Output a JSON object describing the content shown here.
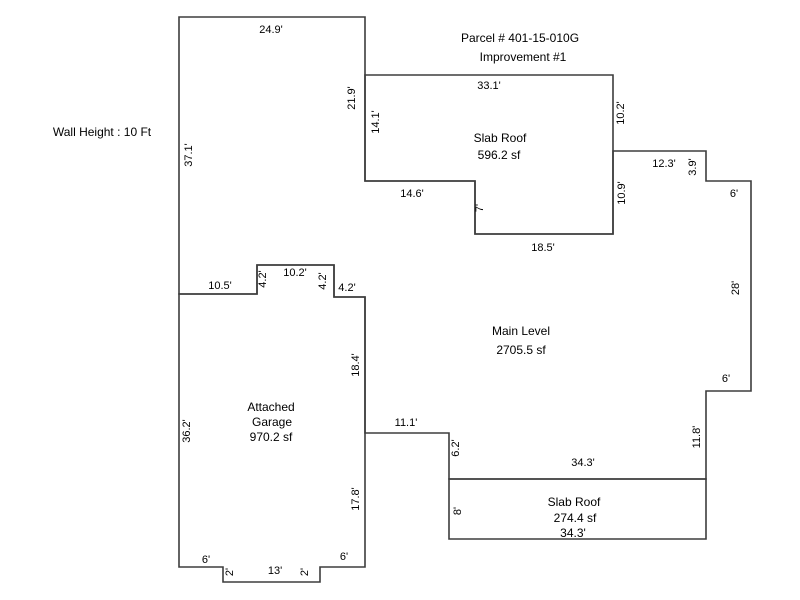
{
  "page": {
    "background": "#ffffff",
    "width": 800,
    "height": 600
  },
  "sketch": {
    "parcel_label": "Parcel # 401-15-010G",
    "improvement_label": "Improvement #1",
    "wall_height_note": "Wall Height : 10 Ft",
    "areas": [
      {
        "name": "Main Level",
        "size": "2705.5 sf"
      },
      {
        "name": "Slab Roof (upper)",
        "size": "596.2 sf"
      },
      {
        "name": "Attached Garage",
        "size": "970.2 sf"
      },
      {
        "name": "Slab Roof (lower)",
        "size": "274.4 sf"
      }
    ]
  },
  "diagram": {
    "stroke": "#3d3d3d",
    "stroke_width": 1.6,
    "fill": "none",
    "text_color": "#000000",
    "dim_font_size": 11,
    "label_font_size": 12,
    "shapes": [
      {
        "name": "main-level-outline",
        "points": [
          [
            179,
            17
          ],
          [
            365,
            17
          ],
          [
            365,
            181
          ],
          [
            475,
            181
          ],
          [
            475,
            234
          ],
          [
            613,
            234
          ],
          [
            613,
            151
          ],
          [
            706,
            151
          ],
          [
            706,
            181
          ],
          [
            751,
            181
          ],
          [
            751,
            391
          ],
          [
            706,
            391
          ],
          [
            706,
            479
          ],
          [
            449,
            479
          ],
          [
            449,
            433
          ],
          [
            365,
            433
          ],
          [
            365,
            297
          ],
          [
            334,
            297
          ],
          [
            334,
            265
          ],
          [
            257,
            265
          ],
          [
            257,
            294
          ],
          [
            179,
            294
          ]
        ]
      },
      {
        "name": "slab-roof-upper-outline",
        "points": [
          [
            365,
            75
          ],
          [
            613,
            75
          ],
          [
            613,
            234
          ],
          [
            475,
            234
          ],
          [
            475,
            181
          ],
          [
            365,
            181
          ]
        ]
      },
      {
        "name": "attached-garage-outline",
        "points": [
          [
            179,
            294
          ],
          [
            257,
            294
          ],
          [
            257,
            265
          ],
          [
            334,
            265
          ],
          [
            334,
            297
          ],
          [
            365,
            297
          ],
          [
            365,
            567
          ],
          [
            320,
            567
          ],
          [
            320,
            582
          ],
          [
            223,
            582
          ],
          [
            223,
            567
          ],
          [
            179,
            567
          ]
        ]
      },
      {
        "name": "slab-roof-lower-outline",
        "points": [
          [
            449,
            479
          ],
          [
            706,
            479
          ],
          [
            706,
            539
          ],
          [
            449,
            539
          ]
        ]
      }
    ],
    "labels": [
      {
        "name": "parcel-number-label",
        "text": "Parcel # 401-15-010G",
        "x": 520,
        "y": 42,
        "rotate": 0,
        "size": 12
      },
      {
        "name": "improvement-number-label",
        "text": "Improvement #1",
        "x": 523,
        "y": 61,
        "rotate": 0,
        "size": 12
      },
      {
        "name": "wall-height-label",
        "text": "Wall Height : 10 Ft",
        "x": 102,
        "y": 136,
        "rotate": 0,
        "size": 12
      },
      {
        "name": "slab-roof-upper-name",
        "text": "Slab Roof",
        "x": 500,
        "y": 142,
        "rotate": 0,
        "size": 12
      },
      {
        "name": "slab-roof-upper-area",
        "text": "596.2 sf",
        "x": 499,
        "y": 159,
        "rotate": 0,
        "size": 12
      },
      {
        "name": "main-level-name",
        "text": "Main Level",
        "x": 521,
        "y": 335,
        "rotate": 0,
        "size": 12
      },
      {
        "name": "main-level-area",
        "text": "2705.5 sf",
        "x": 521,
        "y": 354,
        "rotate": 0,
        "size": 12
      },
      {
        "name": "garage-name-line1",
        "text": "Attached",
        "x": 271,
        "y": 411,
        "rotate": 0,
        "size": 12
      },
      {
        "name": "garage-name-line2",
        "text": "Garage",
        "x": 272,
        "y": 426,
        "rotate": 0,
        "size": 12
      },
      {
        "name": "garage-area",
        "text": "970.2 sf",
        "x": 271,
        "y": 441,
        "rotate": 0,
        "size": 12
      },
      {
        "name": "slab-roof-lower-name",
        "text": "Slab Roof",
        "x": 574,
        "y": 506,
        "rotate": 0,
        "size": 12
      },
      {
        "name": "slab-roof-lower-area",
        "text": "274.4 sf",
        "x": 575,
        "y": 522,
        "rotate": 0,
        "size": 12
      },
      {
        "name": "slab-roof-lower-width",
        "text": "34.3'",
        "x": 573,
        "y": 537,
        "rotate": 0,
        "size": 12
      },
      {
        "name": "dim-main-top",
        "text": "24.9'",
        "x": 271,
        "y": 33,
        "rotate": 0,
        "size": 11
      },
      {
        "name": "dim-main-left-upper",
        "text": "37.1'",
        "x": 192,
        "y": 155,
        "rotate": -90,
        "size": 11
      },
      {
        "name": "dim-main-right-upper",
        "text": "21.9'",
        "x": 355,
        "y": 98,
        "rotate": -90,
        "size": 11
      },
      {
        "name": "dim-slab-upper-left",
        "text": "14.1'",
        "x": 379,
        "y": 122,
        "rotate": -90,
        "size": 11
      },
      {
        "name": "dim-slab-upper-top",
        "text": "33.1'",
        "x": 489,
        "y": 89,
        "rotate": 0,
        "size": 11
      },
      {
        "name": "dim-slab-upper-right1",
        "text": "10.2'",
        "x": 624,
        "y": 113,
        "rotate": -90,
        "size": 11
      },
      {
        "name": "dim-slab-upper-bottom1",
        "text": "14.6'",
        "x": 412,
        "y": 197,
        "rotate": 0,
        "size": 11
      },
      {
        "name": "dim-slab-upper-step",
        "text": "7'",
        "x": 483,
        "y": 208,
        "rotate": -90,
        "size": 11
      },
      {
        "name": "dim-slab-upper-right2",
        "text": "10.9'",
        "x": 625,
        "y": 193,
        "rotate": -90,
        "size": 11
      },
      {
        "name": "dim-slab-upper-bottom2",
        "text": "18.5'",
        "x": 543,
        "y": 251,
        "rotate": 0,
        "size": 11
      },
      {
        "name": "dim-main-ne-step-top",
        "text": "12.3'",
        "x": 664,
        "y": 167,
        "rotate": 0,
        "size": 11
      },
      {
        "name": "dim-main-ne-step-side",
        "text": "3.9'",
        "x": 696,
        "y": 167,
        "rotate": -90,
        "size": 11
      },
      {
        "name": "dim-main-ne-6",
        "text": "6'",
        "x": 734,
        "y": 197,
        "rotate": 0,
        "size": 11
      },
      {
        "name": "dim-main-right-28",
        "text": "28'",
        "x": 739,
        "y": 288,
        "rotate": -90,
        "size": 11
      },
      {
        "name": "dim-main-east-6",
        "text": "6'",
        "x": 726,
        "y": 382,
        "rotate": 0,
        "size": 11
      },
      {
        "name": "dim-main-right-lower",
        "text": "11.8'",
        "x": 700,
        "y": 437,
        "rotate": -90,
        "size": 11
      },
      {
        "name": "dim-main-bottom-34-3",
        "text": "34.3'",
        "x": 583,
        "y": 466,
        "rotate": 0,
        "size": 11
      },
      {
        "name": "dim-main-step-6-2",
        "text": "6.2'",
        "x": 459,
        "y": 448,
        "rotate": -90,
        "size": 11
      },
      {
        "name": "dim-main-step-11-1",
        "text": "11.1'",
        "x": 406,
        "y": 426,
        "rotate": 0,
        "size": 11
      },
      {
        "name": "dim-garage-right-upper",
        "text": "18.4'",
        "x": 359,
        "y": 365,
        "rotate": -90,
        "size": 11
      },
      {
        "name": "dim-garage-right-lower",
        "text": "17.8'",
        "x": 359,
        "y": 499,
        "rotate": -90,
        "size": 11
      },
      {
        "name": "dim-slab-lower-left",
        "text": "8'",
        "x": 461,
        "y": 511,
        "rotate": -90,
        "size": 11
      },
      {
        "name": "dim-garage-top-10-5",
        "text": "10.5'",
        "x": 220,
        "y": 289,
        "rotate": 0,
        "size": 11
      },
      {
        "name": "dim-notch-4-2-left",
        "text": "4.2'",
        "x": 266,
        "y": 279,
        "rotate": -90,
        "size": 11
      },
      {
        "name": "dim-notch-10-2",
        "text": "10.2'",
        "x": 295,
        "y": 276,
        "rotate": 0,
        "size": 11
      },
      {
        "name": "dim-notch-4-2-mid",
        "text": "4.2'",
        "x": 326,
        "y": 281,
        "rotate": -90,
        "size": 11
      },
      {
        "name": "dim-notch-4-2-right",
        "text": "4.2'",
        "x": 347,
        "y": 291,
        "rotate": 0,
        "size": 11
      },
      {
        "name": "dim-garage-left",
        "text": "36.2'",
        "x": 190,
        "y": 431,
        "rotate": -90,
        "size": 11
      },
      {
        "name": "dim-garage-bottom-6-w",
        "text": "6'",
        "x": 206,
        "y": 563,
        "rotate": 0,
        "size": 11
      },
      {
        "name": "dim-garage-bottom-2-w",
        "text": "2'",
        "x": 233,
        "y": 572,
        "rotate": -90,
        "size": 11
      },
      {
        "name": "dim-garage-bottom-13",
        "text": "13'",
        "x": 275,
        "y": 574,
        "rotate": 0,
        "size": 11
      },
      {
        "name": "dim-garage-bottom-2-e",
        "text": "2'",
        "x": 308,
        "y": 572,
        "rotate": -90,
        "size": 11
      },
      {
        "name": "dim-garage-bottom-6-e",
        "text": "6'",
        "x": 344,
        "y": 560,
        "rotate": 0,
        "size": 11
      }
    ]
  }
}
